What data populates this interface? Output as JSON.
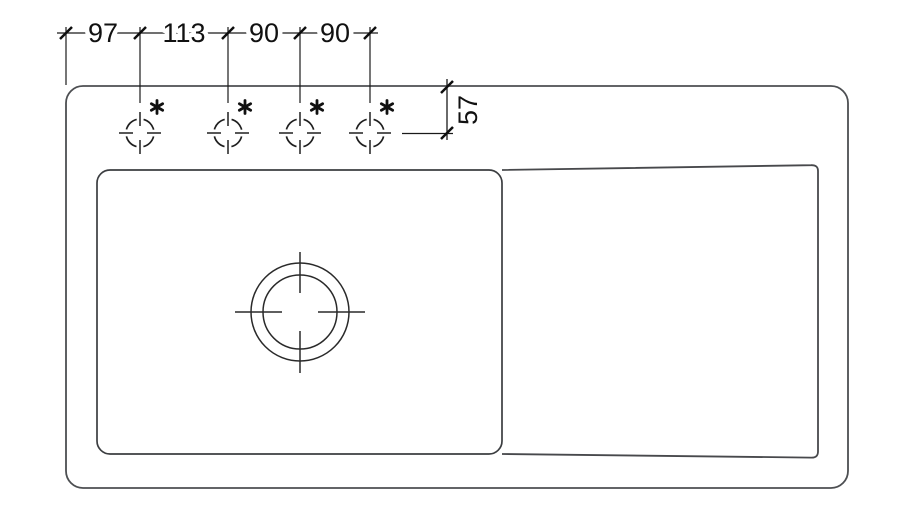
{
  "page": {
    "background": "#ffffff",
    "ink_color": "#1a1a1a",
    "outline_color": "#4d4f52"
  },
  "drawing": {
    "type": "technical-drawing",
    "subject": "sink-plan-view-with-tap-hole-positions",
    "horizontal_dimensions": [
      "97",
      "113",
      "90",
      "90"
    ],
    "vertical_dimension": "57",
    "tap_holes": {
      "count": 4,
      "marker_icon": "asterisk-icon",
      "marker_symbol": "*"
    },
    "features": {
      "bowl": "rounded rectangle with drain",
      "drain": "two concentric circles with center ticks",
      "drainboard": "tapered panel on right side"
    }
  }
}
